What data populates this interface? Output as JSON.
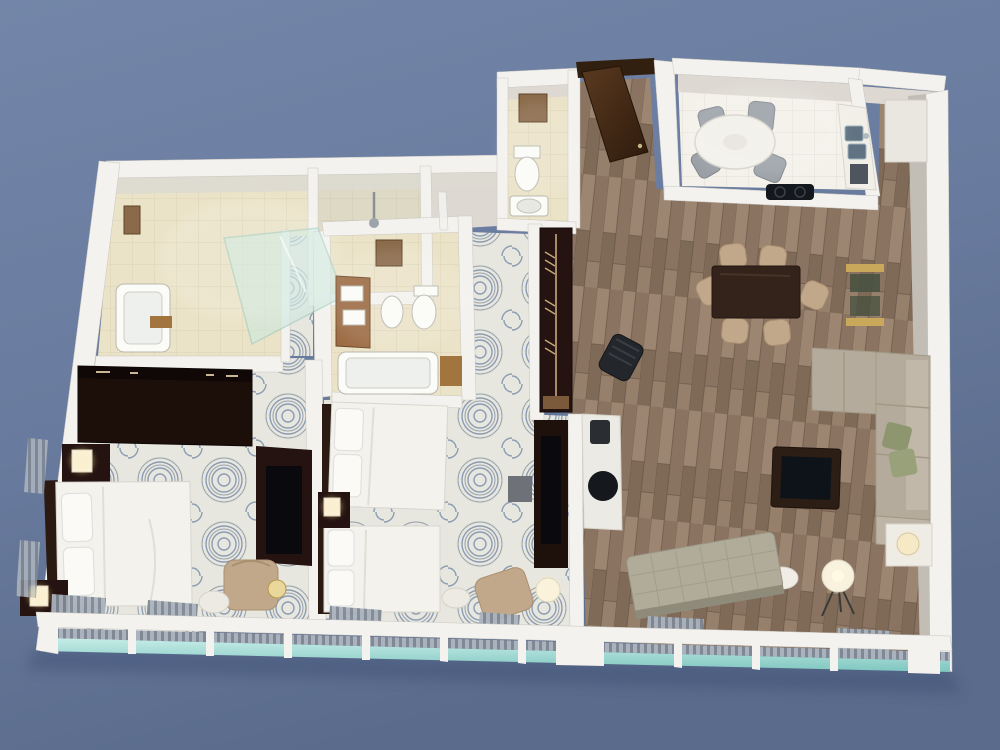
{
  "scene": {
    "type": "3d-floor-plan-render",
    "view": "isometric-top-down",
    "subject": "two-bedroom suite with living room, kitchen, three baths",
    "background": "plain slate-blue"
  },
  "palette": {
    "sky_top": "#7386a9",
    "sky_mid": "#687a9d",
    "sky_bottom": "#5a6b8b",
    "wall_white": "#f3f2ee",
    "wall_stroke": "#c9c6c0",
    "wall_face": "#ddd9d2",
    "wall_greige": "#c3beb5",
    "carpet_base": "#e7e6df",
    "carpet_swirl": "#7b91ad",
    "carpet_swirl_dark": "#53677f",
    "wood_light": "#9c8671",
    "wood_mid": "#8a7361",
    "wood_mid2": "#7f6a58",
    "wood_dark": "#5e4c3d",
    "tile_beige": "#ebe3c8",
    "tile_line": "#d8cead",
    "kitchen_tile": "#f3f1e9",
    "kitchen_line": "#e0ded4",
    "dark_wood": "#2a1710",
    "door_brown": "#4a2e1a",
    "bedding_white": "#f3f2ec",
    "bedding_shadow": "#d8d6ce",
    "tan_chair": "#c2a88a",
    "tan_edge": "#aa9072",
    "sofa_greige": "#b4ab9c",
    "sofa_edge": "#a29886",
    "sofa_back": "#c1b8a9",
    "pillow_leaf": "#8e9670",
    "glass_teal": "#a9ded7",
    "glass_teal_deep": "#7fc6c0",
    "shower_glass": "#cde9e0",
    "blinds_gray": "#aab2bd",
    "blinds_slat": "#7f8894",
    "gold": "#c9a85c",
    "black_glass": "#0d1318",
    "lamp_glow": "#ffe9b0",
    "steel": "#5f7383",
    "art_brown": "#8a6a4a",
    "shadow_blue": "#3e4f74"
  },
  "rooms": [
    {
      "id": "master-bathroom",
      "floor": "beige-tile",
      "items": [
        "bathtub",
        "walk-in-glass-shower",
        "shower-head",
        "wall-art"
      ]
    },
    {
      "id": "guest-bathroom",
      "floor": "beige-tile",
      "items": [
        "wood-vanity-double-sink",
        "bidet",
        "toilet",
        "bathtub",
        "bath-mat",
        "wall-art"
      ]
    },
    {
      "id": "powder-room",
      "floor": "beige-tile",
      "items": [
        "toilet",
        "sink",
        "wall-art"
      ]
    },
    {
      "id": "entry-hall",
      "floor": "wood-plank",
      "items": [
        "open-entry-door",
        "threshold"
      ]
    },
    {
      "id": "kitchen",
      "floor": "white-tile",
      "items": [
        "round-table",
        "chairs-gray",
        "counter-double-sink",
        "appliance",
        "cooktop"
      ]
    },
    {
      "id": "dining-area",
      "floor": "wood-plank",
      "items": [
        "dark-dining-table",
        "six-tan-chairs",
        "gold-glass-console",
        "desk-chair",
        "tall-cabinet"
      ]
    },
    {
      "id": "living-room",
      "floor": "wood-plank",
      "items": [
        "sectional-sofa",
        "throw-pillows",
        "glass-coffee-table",
        "end-table-lamp",
        "tripod-floor-lamp",
        "round-side-table",
        "tufted-bench",
        "media-console"
      ]
    },
    {
      "id": "master-bedroom",
      "floor": "swirl-carpet",
      "items": [
        "wardrobe",
        "king-bed",
        "two-nightstands",
        "two-lamps",
        "tv-dresser",
        "armchair",
        "ottoman",
        "table-lamp"
      ]
    },
    {
      "id": "bedroom-2",
      "floor": "swirl-carpet",
      "items": [
        "double-bed-a",
        "double-bed-b",
        "nightstand-lamp",
        "tv-dresser",
        "side-cube-table",
        "armchair",
        "round-stool",
        "drum-floor-lamp",
        "closet-wardrobe-open"
      ]
    }
  ],
  "windows": {
    "style": "floor-to-ceiling glass band along bottom wall",
    "glass_color": "#8fd0c9",
    "blinds_color": "#8e97a3",
    "panel_count": 11
  }
}
